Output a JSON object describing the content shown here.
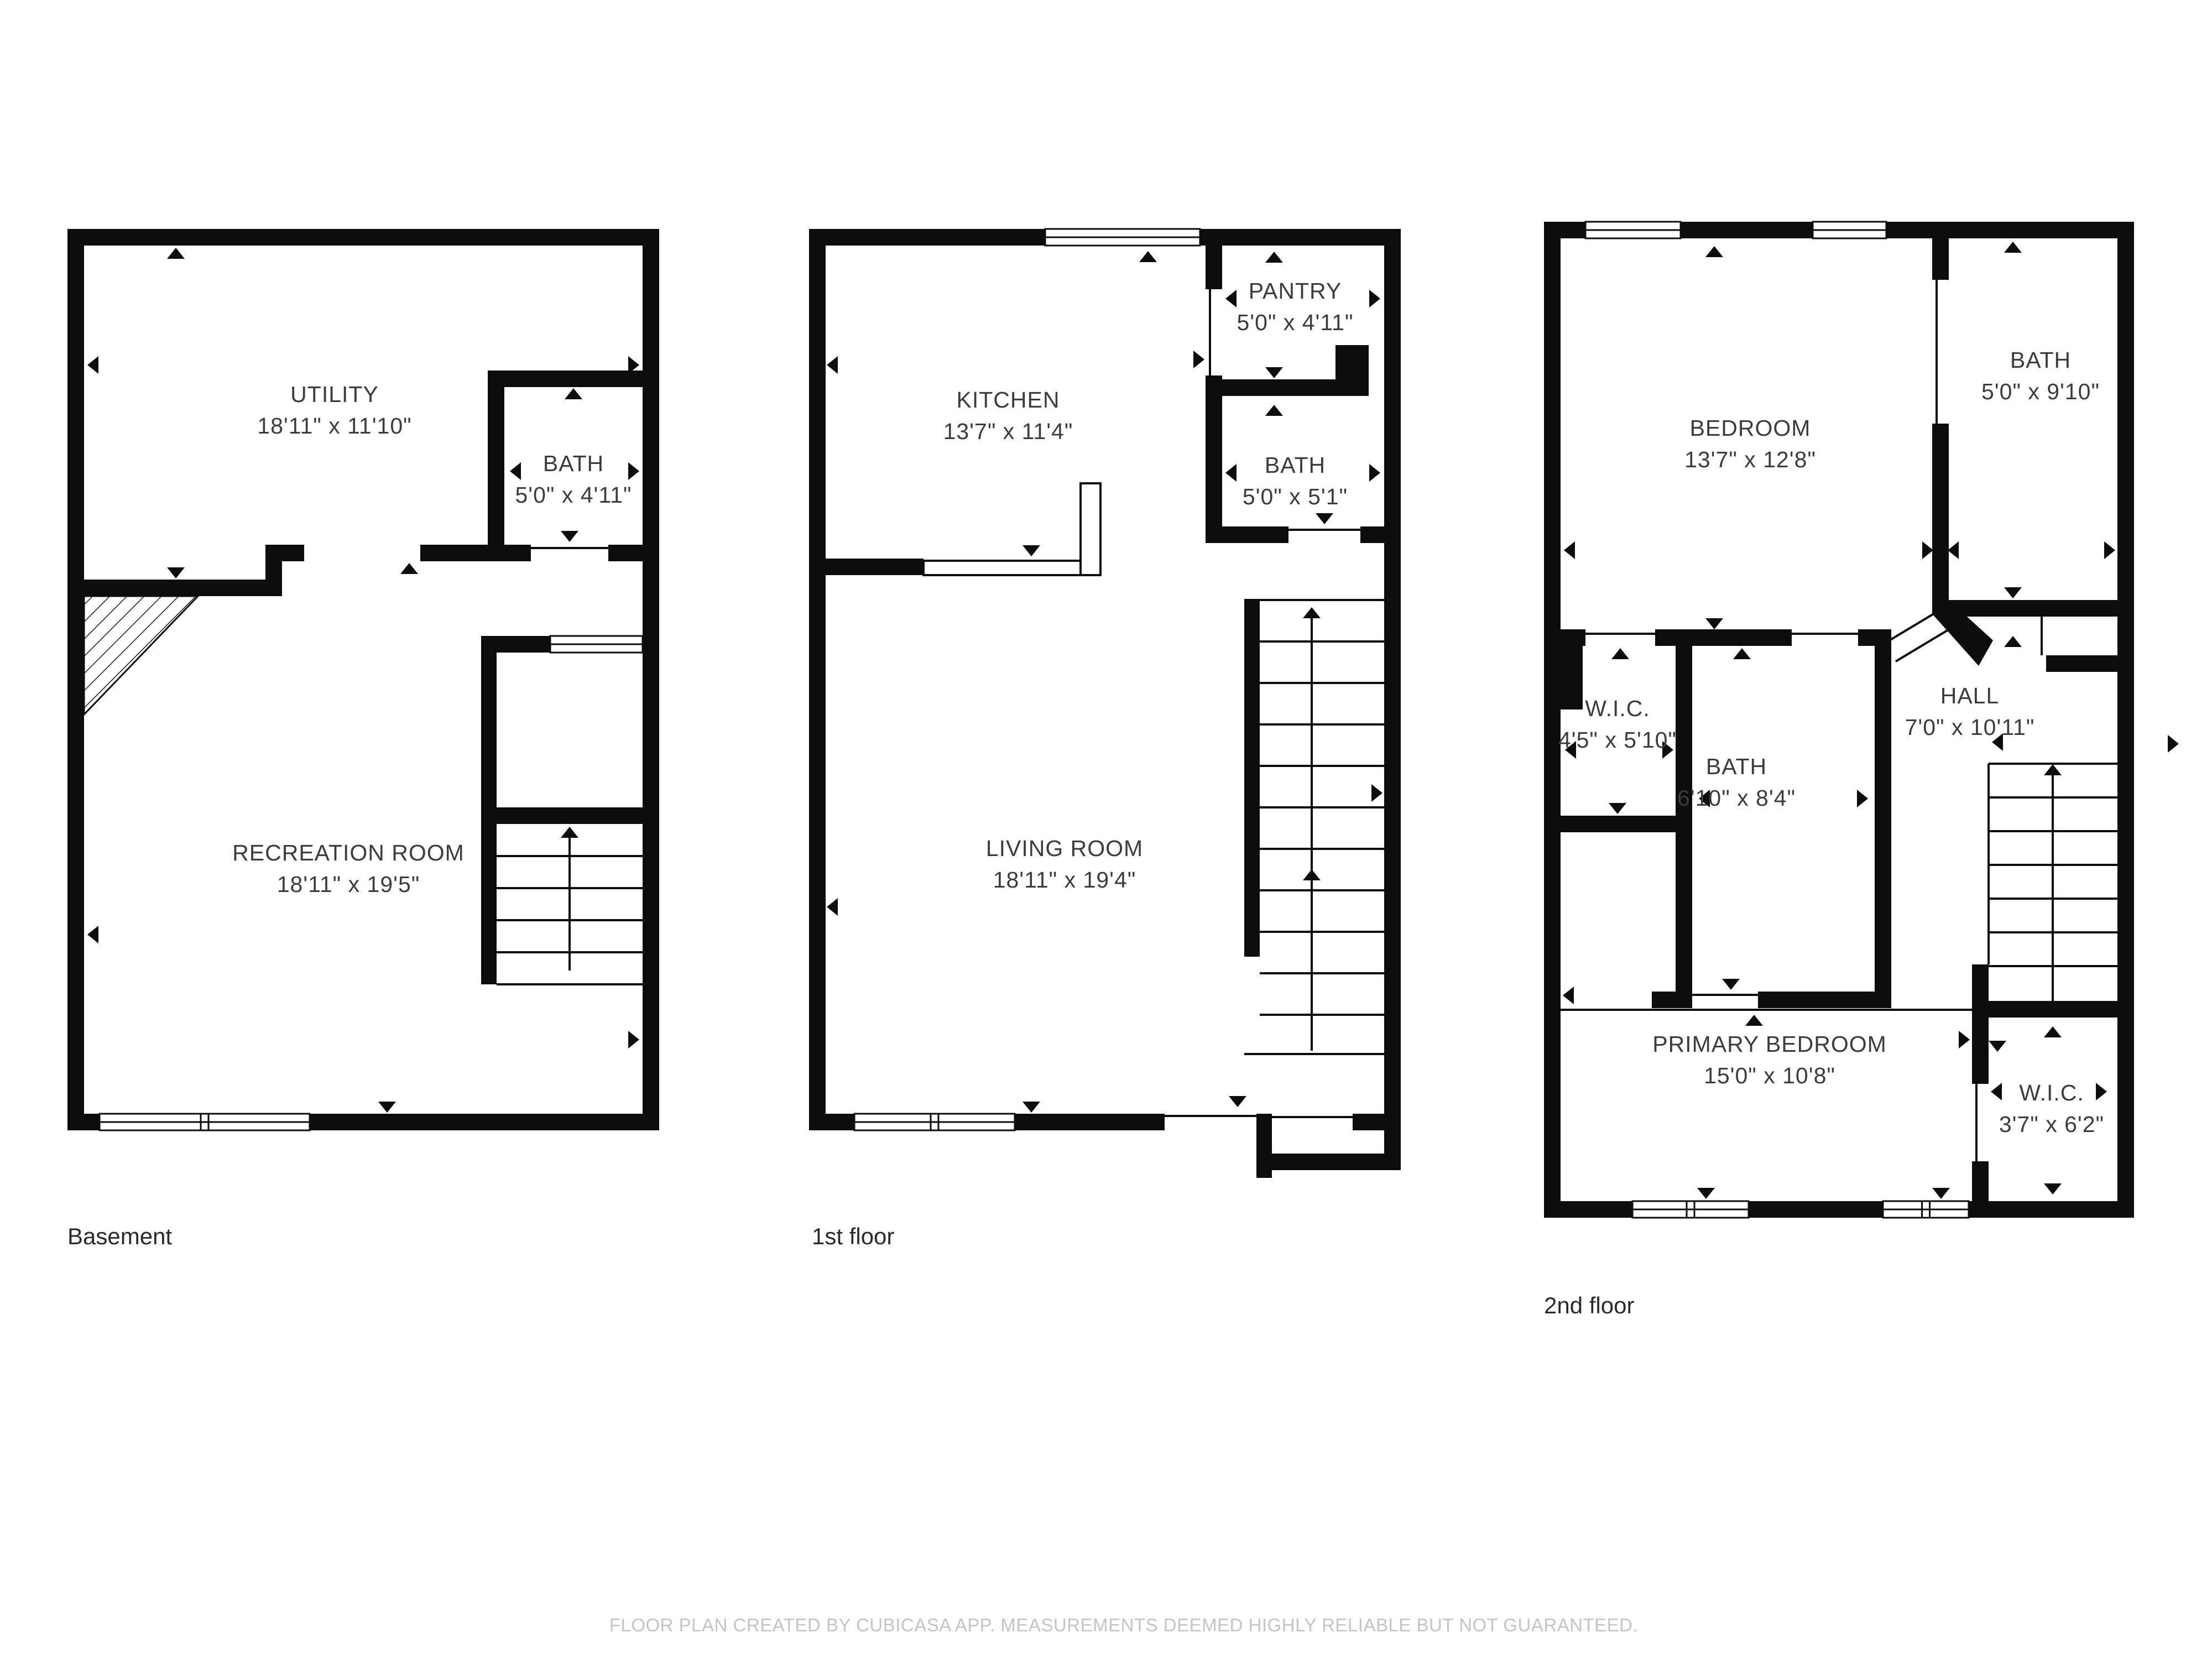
{
  "floors": [
    {
      "label": "Basement",
      "rooms": [
        {
          "name": "UTILITY",
          "dims": "18'11\" x 11'10\""
        },
        {
          "name": "BATH",
          "dims": "5'0\" x 4'11\""
        },
        {
          "name": "RECREATION ROOM",
          "dims": "18'11\" x 19'5\""
        }
      ]
    },
    {
      "label": "1st floor",
      "rooms": [
        {
          "name": "KITCHEN",
          "dims": "13'7\" x 11'4\""
        },
        {
          "name": "PANTRY",
          "dims": "5'0\" x 4'11\""
        },
        {
          "name": "BATH",
          "dims": "5'0\" x 5'1\""
        },
        {
          "name": "LIVING ROOM",
          "dims": "18'11\" x 19'4\""
        }
      ]
    },
    {
      "label": "2nd floor",
      "rooms": [
        {
          "name": "BEDROOM",
          "dims": "13'7\" x 12'8\""
        },
        {
          "name": "BATH",
          "dims": "5'0\" x 9'10\""
        },
        {
          "name": "W.I.C.",
          "dims": "4'5\" x 5'10\""
        },
        {
          "name": "BATH",
          "dims": "6'10\" x 8'4\""
        },
        {
          "name": "HALL",
          "dims": "7'0\" x 10'11\""
        },
        {
          "name": "PRIMARY BEDROOM",
          "dims": "15'0\" x 10'8\""
        },
        {
          "name": "W.I.C.",
          "dims": "3'7\" x 6'2\""
        }
      ]
    }
  ],
  "footer": "FLOOR PLAN CREATED BY CUBICASA APP. MEASUREMENTS DEEMED HIGHLY RELIABLE BUT NOT GUARANTEED.",
  "colors": {
    "wall": "#0d0d0d",
    "label": "#3c3c3c",
    "floor_label": "#2a2a2a",
    "footer": "#c4c4c4"
  }
}
